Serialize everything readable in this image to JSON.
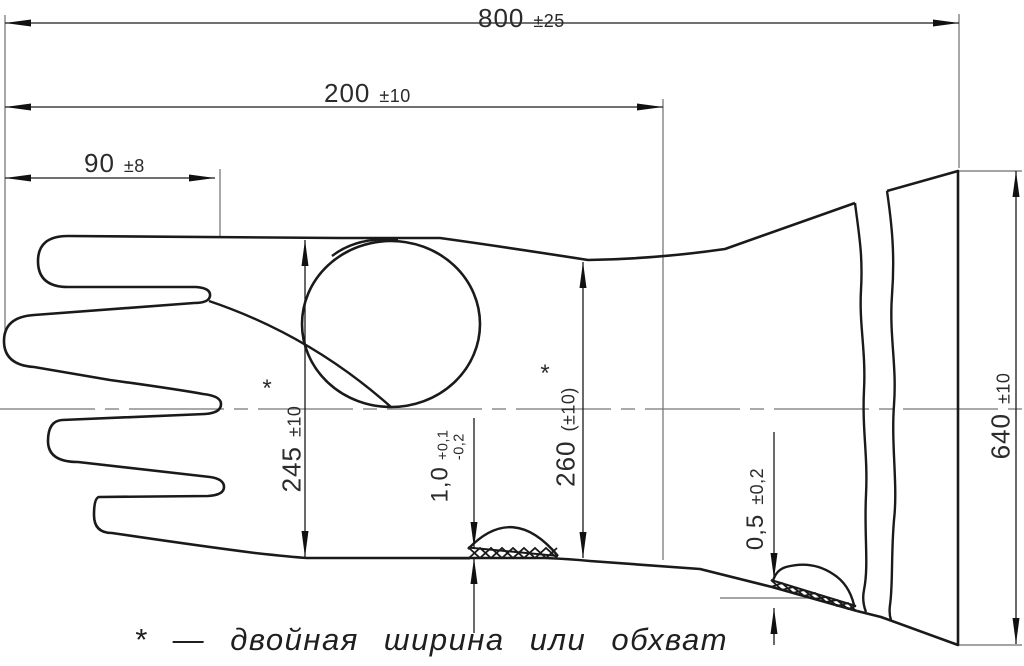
{
  "drawing_type": "glove-technical-drawing",
  "dimensions": {
    "overall_length": {
      "value": "800",
      "tolerance": "±25"
    },
    "hand_length": {
      "value": "200",
      "tolerance": "±10"
    },
    "finger_length": {
      "value": "90",
      "tolerance": "±8"
    },
    "palm_width": {
      "value": "245",
      "tolerance": "±10",
      "marker": "*"
    },
    "wrist_width": {
      "value": "260",
      "tolerance": "(±10)",
      "marker": "*"
    },
    "palm_patch_thickness": {
      "value": "1,0",
      "tolerance_plus": "+0,1",
      "tolerance_minus": "-0,2"
    },
    "cuff_patch_thickness": {
      "value": "0,5",
      "tolerance": "±0,2"
    },
    "cuff_width": {
      "value": "640",
      "tolerance": "±10"
    }
  },
  "footnote": {
    "text": "* — двойная ширина или обхват"
  },
  "colors": {
    "outline": "#1a1a1a",
    "thin_line": "#6f6f6f",
    "background": "#ffffff"
  }
}
